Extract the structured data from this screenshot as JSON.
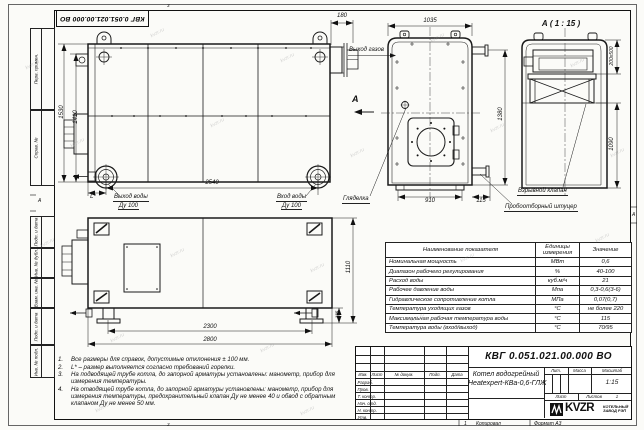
{
  "sheet": {
    "watermark": "kvzr.ru",
    "zone_left": "А",
    "zone_right": "А",
    "fold_top": "3",
    "fold_bottom": "3",
    "zone_bottom_num": "1",
    "copied": "Копировал",
    "format": "Формат А3"
  },
  "margin": {
    "top_labels": [
      "Перв. примен.",
      "Справ. №"
    ],
    "bottom_labels": [
      "Подп. и дата",
      "Инв. № дубл.",
      "Взам. инв. №",
      "Подп. и дата",
      "Инв. № подл."
    ]
  },
  "doc": {
    "number": "КВГ 0.051.021.00.000 ВО",
    "name1": "Котел водогрейный",
    "name2": "Heatexpert-КВа-0,6-ГЛЖ",
    "scale": "1:15",
    "sheets_count": "1"
  },
  "title_block": {
    "cols": [
      "Изм.",
      "Лист",
      "№ докум.",
      "Подп.",
      "Дата"
    ],
    "rows": [
      "Разраб.",
      "Пров.",
      "Т. контр.",
      "Нач. отд.",
      "Н. контр.",
      "Утв."
    ],
    "lit": "Лит.",
    "mass": "Масса",
    "scale_label": "Масштаб",
    "sheet_label": "Лист",
    "sheets_label": "Листов",
    "logo_text": "KVZR",
    "logo_caption1": "КОТЕЛЬНЫЙ",
    "logo_caption2": "ЗАВОД РЭП"
  },
  "params": {
    "h_name": "Наименование показателя",
    "h_units": "Единицы измерения",
    "h_value": "Значение",
    "rows": [
      [
        "Номинальная мощность",
        "МВт",
        "0,6"
      ],
      [
        "Диапазон рабочего регулирования",
        "%",
        "40-100"
      ],
      [
        "Расход воды",
        "куб.м/ч",
        "21"
      ],
      [
        "Рабочее давление воды",
        "Мпа",
        "0,3-0,6(3-6)"
      ],
      [
        "Гидравлическое сопротивление котла",
        "МПа",
        "0,07(0,7)"
      ],
      [
        "Температура уходящих газов",
        "°С",
        "не более 220"
      ],
      [
        "Максимальная рабочая температура воды",
        "°С",
        "115"
      ],
      [
        "Температура воды (вход/выход)",
        "°С",
        "70/95"
      ]
    ]
  },
  "notes": [
    {
      "num": "1.",
      "text": "Все размеры для справок, допустимые отклонения ± 100 мм."
    },
    {
      "num": "2.",
      "text": "L* – размер выполняется согласно требований горелки."
    },
    {
      "num": "3.",
      "text": "На подводящей трубе котла, до запорной арматуры установлены: манометр, прибор для измерения температуры."
    },
    {
      "num": "4.",
      "text": "На отводящей трубе котла, до запорной арматуры установлены: манометр, прибор для измерения температуры, предохранительный клапан Ду не менее 40 и обвод с обратным клапаном Ду не менее 50 мм."
    }
  ],
  "views": {
    "side": {
      "h1530": "1530",
      "h1410": "1410",
      "w2540": "2540",
      "l": "L*",
      "gas180": "180",
      "out1": "Выход воды",
      "out2": "Ду 100",
      "in1": "Вход воды",
      "in2": "Ду 100",
      "gas": "Выход газов"
    },
    "front": {
      "w1035": "1035",
      "w910": "910",
      "w115": "115",
      "h1380": "1380",
      "arrow": "А",
      "sight": "Гляделка",
      "sampling": "Пробоотборный штуцер"
    },
    "detail": {
      "title": "А ( 1 : 15 )",
      "valve_dim": "200х500",
      "h1090": "1090",
      "valve": "Взрывной клапан"
    },
    "plan": {
      "w2300": "2300",
      "w2800": "2800",
      "h1110": "1110",
      "leg185": "185"
    }
  }
}
